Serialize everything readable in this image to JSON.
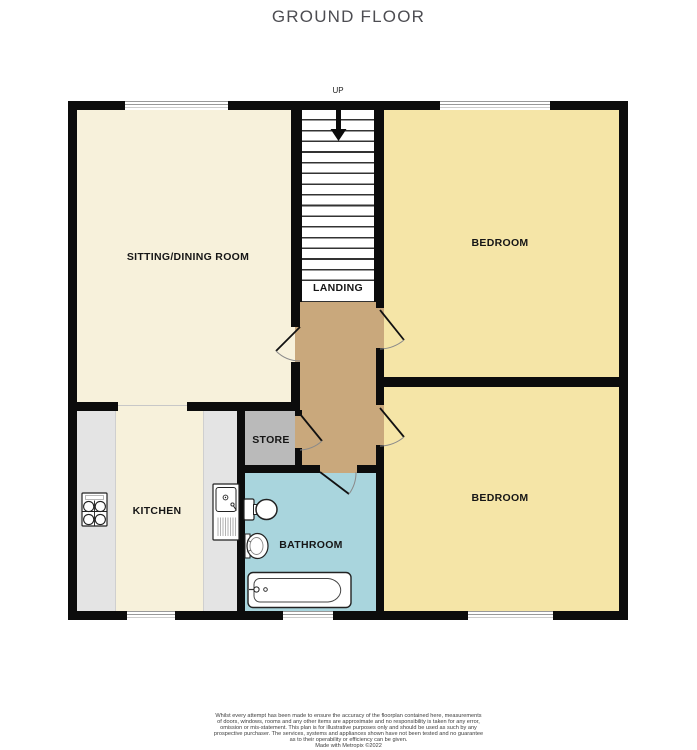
{
  "title": "GROUND FLOOR",
  "stairs": {
    "direction_label": "UP",
    "landing_label": "LANDING"
  },
  "rooms": {
    "sitting_dining": {
      "label": "SITTING/DINING ROOM"
    },
    "bedroom_top": {
      "label": "BEDROOM"
    },
    "bedroom_bottom": {
      "label": "BEDROOM"
    },
    "kitchen": {
      "label": "KITCHEN"
    },
    "store": {
      "label": "STORE"
    },
    "bathroom": {
      "label": "BATHROOM"
    }
  },
  "fixtures": {
    "kitchen": [
      "hob-icon",
      "sink-icon"
    ],
    "bathroom": [
      "toilet-icon",
      "basin-icon",
      "bathtub-icon"
    ]
  },
  "colors": {
    "wall": "#0c0c0c",
    "sitting_kitchen_floor": "#F7F1DB",
    "bedroom_floor": "#F5E5A7",
    "hallway_floor": "#C9A87C",
    "store_floor": "#BABABA",
    "bathroom_floor": "#A9D5DD",
    "counter": "#E4E4E4"
  },
  "disclaimer": {
    "lines": [
      "Whilst every attempt has been made to ensure the accuracy of the floorplan contained here, measurements",
      "of doors, windows, rooms and any other items are approximate and no responsibility is taken for any error,",
      "omission or mis-statement. This plan is for illustrative purposes only and should be used as such by any",
      "prospective purchaser. The services, systems and appliances shown have not been tested and no guarantee",
      "as to their operability or efficiency can be given.",
      "Made with Metropix ©2022"
    ]
  }
}
